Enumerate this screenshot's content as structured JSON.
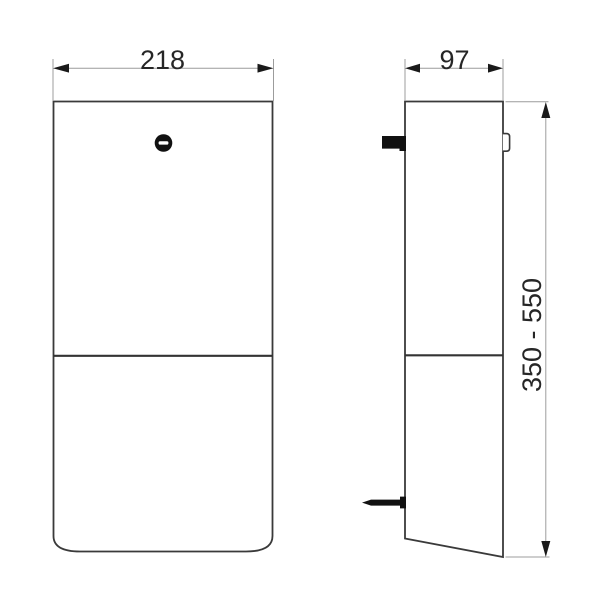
{
  "page": {
    "background": "#ffffff",
    "title": "dispenser-dimension-drawing"
  },
  "drawing": {
    "type": "technical-dimension-drawing",
    "views": {
      "front": {
        "name": "front view",
        "width_label": "218",
        "icon": "slotted-screw-icon"
      },
      "side": {
        "name": "side view",
        "depth_label": "97",
        "height_label": "350 - 550"
      }
    },
    "colors": {
      "outline": "#3a3a3a",
      "divider": "#333333",
      "dimension_line": "#9c9c9c",
      "arrow_and_text": "#1a1a1a",
      "solid_detail": "#111111",
      "background": "#ffffff"
    }
  }
}
